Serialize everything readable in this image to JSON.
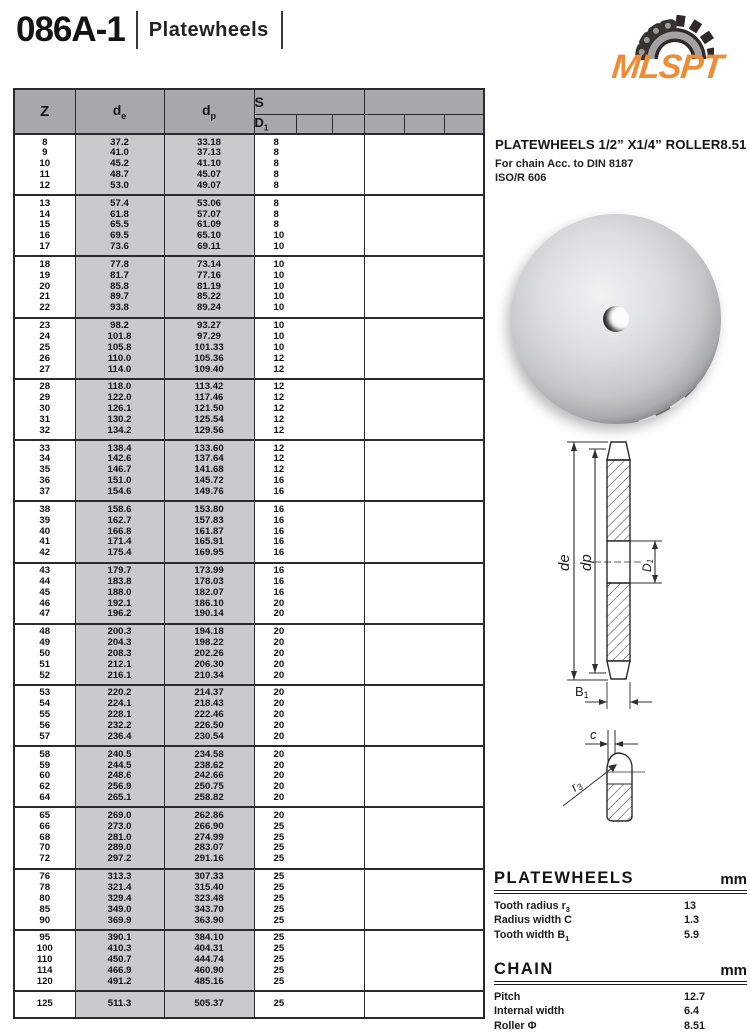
{
  "page": {
    "code": "086A-1",
    "category": "Platewheels"
  },
  "logo": {
    "text": "MLSPT",
    "orange": "#ee8d35",
    "icon": "chain-sprocket-icon"
  },
  "product": {
    "headline": "PLATEWHEELS 1/2” X1/4” ROLLER8.51",
    "subline1": "For chain Acc. to DIN 8187",
    "subline2": "ISO/R 606"
  },
  "table": {
    "headers": {
      "z": "Z",
      "de_base": "d",
      "de_sub": "e",
      "dp_base": "d",
      "dp_sub": "p",
      "s": "S",
      "d1_base": "D",
      "d1_sub": "1"
    },
    "groups": [
      {
        "rows": [
          [
            "8",
            "37.2",
            "33.18",
            "8"
          ],
          [
            "9",
            "41.0",
            "37.13",
            "8"
          ],
          [
            "10",
            "45.2",
            "41.10",
            "8"
          ],
          [
            "11",
            "48.7",
            "45.07",
            "8"
          ],
          [
            "12",
            "53.0",
            "49.07",
            "8"
          ]
        ]
      },
      {
        "rows": [
          [
            "13",
            "57.4",
            "53.06",
            "8"
          ],
          [
            "14",
            "61.8",
            "57.07",
            "8"
          ],
          [
            "15",
            "65.5",
            "61.09",
            "8"
          ],
          [
            "16",
            "69.5",
            "65.10",
            "10"
          ],
          [
            "17",
            "73.6",
            "69.11",
            "10"
          ]
        ]
      },
      {
        "rows": [
          [
            "18",
            "77.8",
            "73.14",
            "10"
          ],
          [
            "19",
            "81.7",
            "77.16",
            "10"
          ],
          [
            "20",
            "85.8",
            "81.19",
            "10"
          ],
          [
            "21",
            "89.7",
            "85.22",
            "10"
          ],
          [
            "22",
            "93.8",
            "89.24",
            "10"
          ]
        ]
      },
      {
        "rows": [
          [
            "23",
            "98.2",
            "93.27",
            "10"
          ],
          [
            "24",
            "101.8",
            "97.29",
            "10"
          ],
          [
            "25",
            "105.8",
            "101.33",
            "10"
          ],
          [
            "26",
            "110.0",
            "105.36",
            "12"
          ],
          [
            "27",
            "114.0",
            "109.40",
            "12"
          ]
        ]
      },
      {
        "rows": [
          [
            "28",
            "118.0",
            "113.42",
            "12"
          ],
          [
            "29",
            "122.0",
            "117.46",
            "12"
          ],
          [
            "30",
            "126.1",
            "121.50",
            "12"
          ],
          [
            "31",
            "130.2",
            "125.54",
            "12"
          ],
          [
            "32",
            "134.2",
            "129.56",
            "12"
          ]
        ]
      },
      {
        "rows": [
          [
            "33",
            "138.4",
            "133.60",
            "12"
          ],
          [
            "34",
            "142.6",
            "137.64",
            "12"
          ],
          [
            "35",
            "146.7",
            "141.68",
            "12"
          ],
          [
            "36",
            "151.0",
            "145.72",
            "16"
          ],
          [
            "37",
            "154.6",
            "149.76",
            "16"
          ]
        ]
      },
      {
        "rows": [
          [
            "38",
            "158.6",
            "153.80",
            "16"
          ],
          [
            "39",
            "162.7",
            "157.83",
            "16"
          ],
          [
            "40",
            "166.8",
            "161.87",
            "16"
          ],
          [
            "41",
            "171.4",
            "165.91",
            "16"
          ],
          [
            "42",
            "175.4",
            "169.95",
            "16"
          ]
        ]
      },
      {
        "rows": [
          [
            "43",
            "179.7",
            "173.99",
            "16"
          ],
          [
            "44",
            "183.8",
            "178.03",
            "16"
          ],
          [
            "45",
            "188.0",
            "182.07",
            "16"
          ],
          [
            "46",
            "192.1",
            "186.10",
            "20"
          ],
          [
            "47",
            "196.2",
            "190.14",
            "20"
          ]
        ]
      },
      {
        "rows": [
          [
            "48",
            "200.3",
            "194.18",
            "20"
          ],
          [
            "49",
            "204.3",
            "198.22",
            "20"
          ],
          [
            "50",
            "208.3",
            "202.26",
            "20"
          ],
          [
            "51",
            "212.1",
            "206.30",
            "20"
          ],
          [
            "52",
            "216.1",
            "210.34",
            "20"
          ]
        ]
      },
      {
        "rows": [
          [
            "53",
            "220.2",
            "214.37",
            "20"
          ],
          [
            "54",
            "224.1",
            "218.43",
            "20"
          ],
          [
            "55",
            "228.1",
            "222.46",
            "20"
          ],
          [
            "56",
            "232.2",
            "226.50",
            "20"
          ],
          [
            "57",
            "236.4",
            "230.54",
            "20"
          ]
        ]
      },
      {
        "rows": [
          [
            "58",
            "240.5",
            "234.58",
            "20"
          ],
          [
            "59",
            "244.5",
            "238.62",
            "20"
          ],
          [
            "60",
            "248.6",
            "242.66",
            "20"
          ],
          [
            "62",
            "256.9",
            "250.75",
            "20"
          ],
          [
            "64",
            "265.1",
            "258.82",
            "20"
          ]
        ]
      },
      {
        "rows": [
          [
            "65",
            "269.0",
            "262.86",
            "20"
          ],
          [
            "66",
            "273.0",
            "266.90",
            "25"
          ],
          [
            "68",
            "281.0",
            "274.99",
            "25"
          ],
          [
            "70",
            "289.0",
            "283.07",
            "25"
          ],
          [
            "72",
            "297.2",
            "291.16",
            "25"
          ]
        ]
      },
      {
        "rows": [
          [
            "76",
            "313.3",
            "307.33",
            "25"
          ],
          [
            "78",
            "321.4",
            "315.40",
            "25"
          ],
          [
            "80",
            "329.4",
            "323.48",
            "25"
          ],
          [
            "85",
            "349.0",
            "343.70",
            "25"
          ],
          [
            "90",
            "369.9",
            "363.90",
            "25"
          ]
        ]
      },
      {
        "rows": [
          [
            "95",
            "390.1",
            "384.10",
            "25"
          ],
          [
            "100",
            "410.3",
            "404.31",
            "25"
          ],
          [
            "110",
            "450.7",
            "444.74",
            "25"
          ],
          [
            "114",
            "466.9",
            "460.90",
            "25"
          ],
          [
            "120",
            "491.2",
            "485.16",
            "25"
          ]
        ]
      },
      {
        "rows": [
          [
            "125",
            "511.3",
            "505.37",
            "25"
          ]
        ]
      }
    ]
  },
  "drawing": {
    "de": "de",
    "dp": "dp",
    "d1_base": "D",
    "d1_sub": "1",
    "b1_base": "B",
    "b1_sub": "1",
    "c": "c",
    "r3_base": "r",
    "r3_sub": "3"
  },
  "specs": {
    "platewheels": {
      "title": "PLATEWHEELS",
      "unit": "mm",
      "rows": [
        {
          "label": "Tooth radius r",
          "sub": "3",
          "value": "13"
        },
        {
          "label": "Radius width C",
          "sub": "",
          "value": "1.3"
        },
        {
          "label": "Tooth width B",
          "sub": "1",
          "value": "5.9"
        }
      ]
    },
    "chain": {
      "title": "CHAIN",
      "unit": "mm",
      "rows": [
        {
          "label": "Pitch",
          "sub": "",
          "value": "12.7"
        },
        {
          "label": "Internal width",
          "sub": "",
          "value": "6.4"
        },
        {
          "label": "Roller Φ",
          "sub": "",
          "value": "8.51"
        }
      ]
    }
  }
}
